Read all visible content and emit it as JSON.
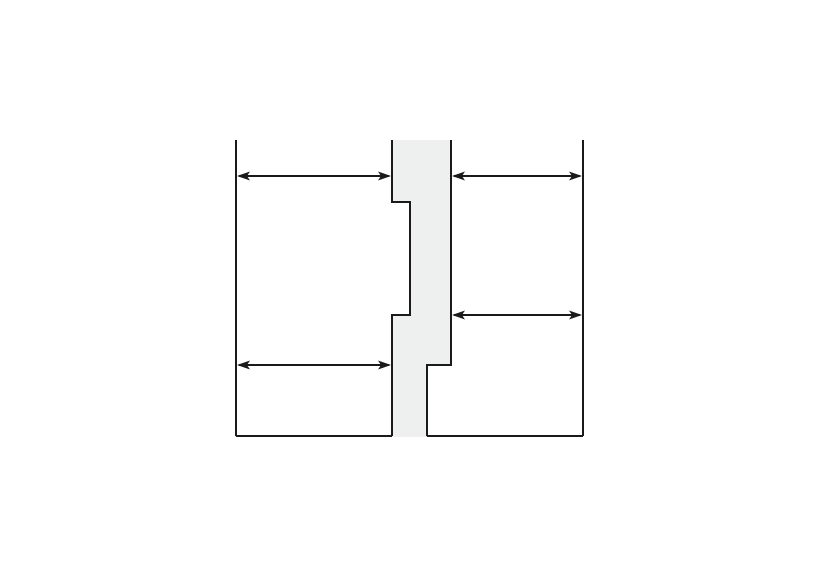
{
  "canvas": {
    "width": 820,
    "height": 580,
    "background_color": "#ffffff"
  },
  "diagram": {
    "description": "panel-joint-cross-section",
    "stroke_color": "#1a1a1a",
    "fill_color": "#edf0ee",
    "line_width": 2,
    "arrow_line_width": 2,
    "arrowhead": {
      "length": 13,
      "half_width": 4.5,
      "barb_inset": 10
    },
    "outer_lines": [
      {
        "name": "left-panel-outer-edge-line",
        "x1": 236,
        "y1": 140,
        "x2": 236,
        "y2": 436
      },
      {
        "name": "right-panel-outer-edge-line",
        "x1": 583,
        "y1": 140,
        "x2": 583,
        "y2": 436
      },
      {
        "name": "left-panel-bottom-edge-line",
        "x1": 236,
        "y1": 436,
        "x2": 392,
        "y2": 436
      },
      {
        "name": "right-panel-bottom-edge-line",
        "x1": 427,
        "y1": 436,
        "x2": 583,
        "y2": 436
      }
    ],
    "joint": {
      "fill_points": "392,140 451,140 451,365 427,365 427,437 392,437 392,315 410,315 410,202 392,202",
      "left_edge_path": "M392,140 L392,202 L410,202 L410,315 L392,315 L392,436",
      "right_edge_path": "M451,140 L451,365 L427,365 L427,436"
    },
    "dimension_arrows": [
      {
        "name": "dimension-arrow-top-left",
        "y": 176,
        "x1": 237,
        "x2": 391
      },
      {
        "name": "dimension-arrow-top-right",
        "y": 176,
        "x1": 452,
        "x2": 582
      },
      {
        "name": "dimension-arrow-middle-right",
        "y": 315,
        "x1": 452,
        "x2": 582
      },
      {
        "name": "dimension-arrow-bottom-left",
        "y": 365,
        "x1": 237,
        "x2": 391
      }
    ]
  }
}
